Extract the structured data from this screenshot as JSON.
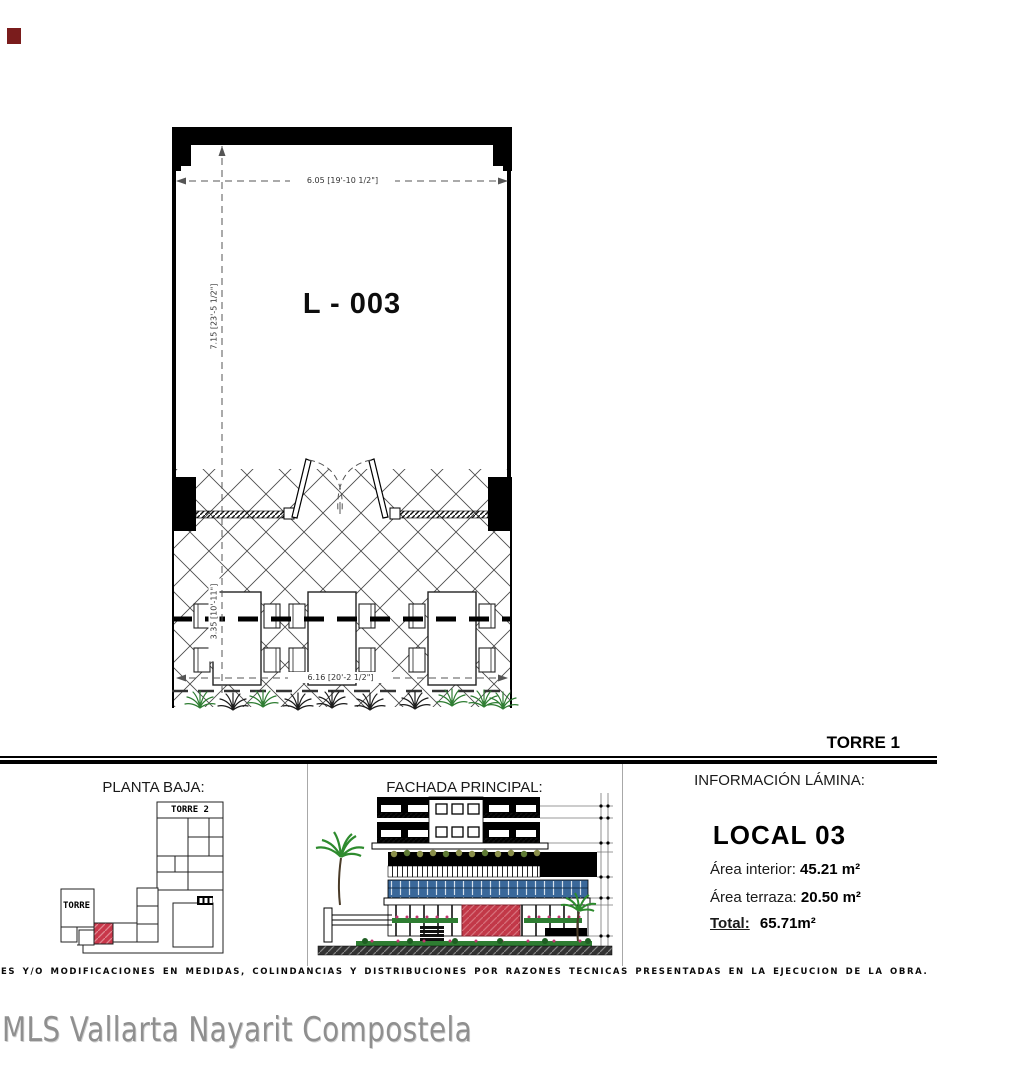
{
  "plan": {
    "unit_label": "L - 003",
    "dim_width_top": "6.05 [19'-10 1/2\"]",
    "dim_height_left": "7.15 [23'-5 1/2\"]",
    "dim_terrace_left": "3.35 [10'-11\"]",
    "dim_width_bottom": "6.16 [20'-2 1/2\"]"
  },
  "header": {
    "torre": "TORRE 1"
  },
  "sections": {
    "planta_baja": {
      "title": "PLANTA BAJA:",
      "torre2_label": "TORRE 2",
      "torre1_label": "TORRE 1"
    },
    "fachada": {
      "title": "FACHADA PRINCIPAL:"
    },
    "info": {
      "title": "INFORMACIÓN LÁMINA:",
      "local": "LOCAL 03",
      "rows": [
        {
          "label": "Área interior:",
          "value": "45.21 m²"
        },
        {
          "label": "Área terraza:",
          "value": "20.50 m²"
        },
        {
          "label": "Total:",
          "value": "65.71m²"
        }
      ]
    }
  },
  "disclaimer": "ES Y/O MODIFICACIONES EN MEDIDAS, COLINDANCIAS Y DISTRIBUCIONES POR RAZONES TÉCNICAS PRESENTADAS EN LA EJECUCIÓN DE LA OBRA.",
  "watermark": "MLS Vallarta Nayarit Compostela",
  "colors": {
    "highlight_red": "#c23848",
    "plant_green": "#2e7d32",
    "window_blue": "#3a689a",
    "olive_plants": "#8a8f4a",
    "marker_red": "#7a1c1c"
  }
}
